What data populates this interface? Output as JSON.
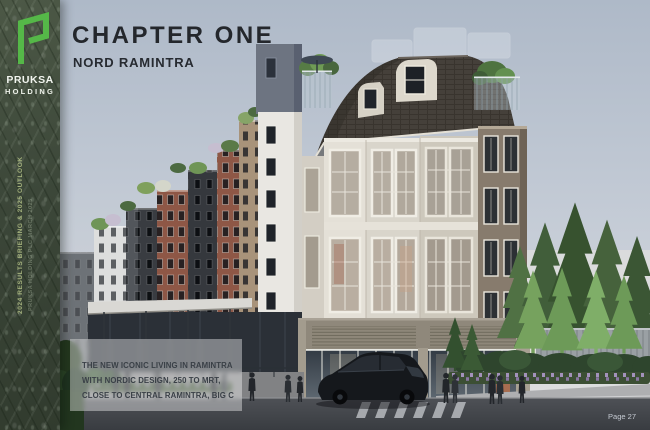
{
  "slide": {
    "title": "CHAPTER ONE",
    "subtitle": "NORD RAMINTRA",
    "page_label": "Page 27",
    "highlight_lines": [
      "THE NEW ICONIC LIVING IN RAMINTRA",
      "WITH NORDIC DESIGN, 250 TO MRT,",
      "CLOSE TO CENTRAL RAMINTRA, BIG C"
    ]
  },
  "sidebar": {
    "brand_name_line1": "PRUKSA",
    "brand_name_line2": "HOLDING",
    "vertical_text_primary": "2024 RESULTS BRIEFING & 2025 OUTLOOK",
    "vertical_text_secondary": "PRUKSA HOLDING PLC MARCH 2025",
    "colors": {
      "background_green": "#424d3e",
      "logo_green": "#55b848",
      "vertical_text": "#a3b07c"
    }
  },
  "artwork": {
    "alt": "Architectural rendering of the Nord Ramintra low-rise condominium: Nordic-style buildings with mansard roof, rooftop gardens, street-level shops, pedestrians, a parked car and pine trees",
    "colors": {
      "sky": "#b4bfcc",
      "roof_shingle": "#45403a",
      "cream_facade": "#d9d5cb",
      "taupe_facade": "#877b6d",
      "brick_facade": "#8e5746",
      "charcoal_facade": "#35383d",
      "tree_green": "#4a6a42",
      "road": "#46494e",
      "highlight_panel": "rgba(255,255,255,0.40)"
    }
  }
}
